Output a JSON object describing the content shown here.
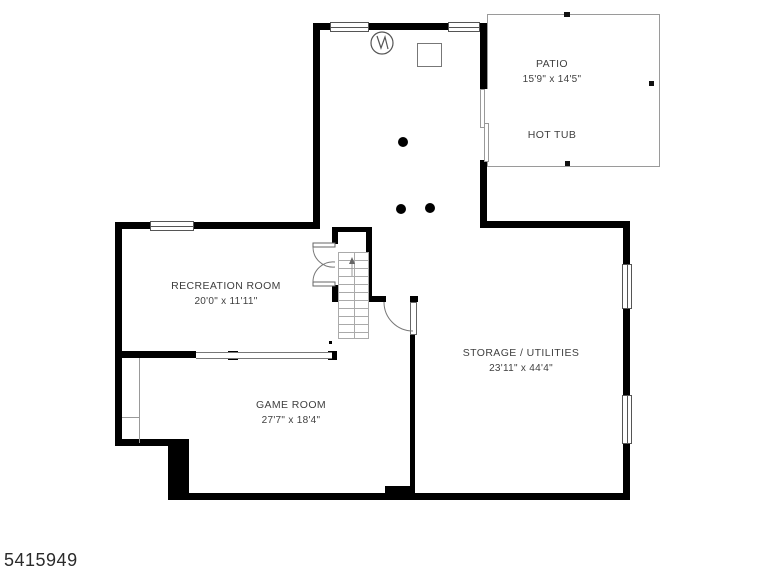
{
  "watermark": {
    "listing_id": "5415949"
  },
  "rooms": {
    "patio": {
      "name": "PATIO",
      "dims": "15'9\" x 14'5\"",
      "feature": "HOT TUB"
    },
    "recreation": {
      "name": "RECREATION ROOM",
      "dims": "20'0\" x 11'11\""
    },
    "game": {
      "name": "GAME ROOM",
      "dims": "27'7\" x 18'4\""
    },
    "storage": {
      "name": "STORAGE / UTILITIES",
      "dims": "23'11\" x 44'4\""
    }
  },
  "colors": {
    "wall": "#000000",
    "thin_line": "#999999",
    "text": "#3f3f3f",
    "background": "#ffffff"
  }
}
